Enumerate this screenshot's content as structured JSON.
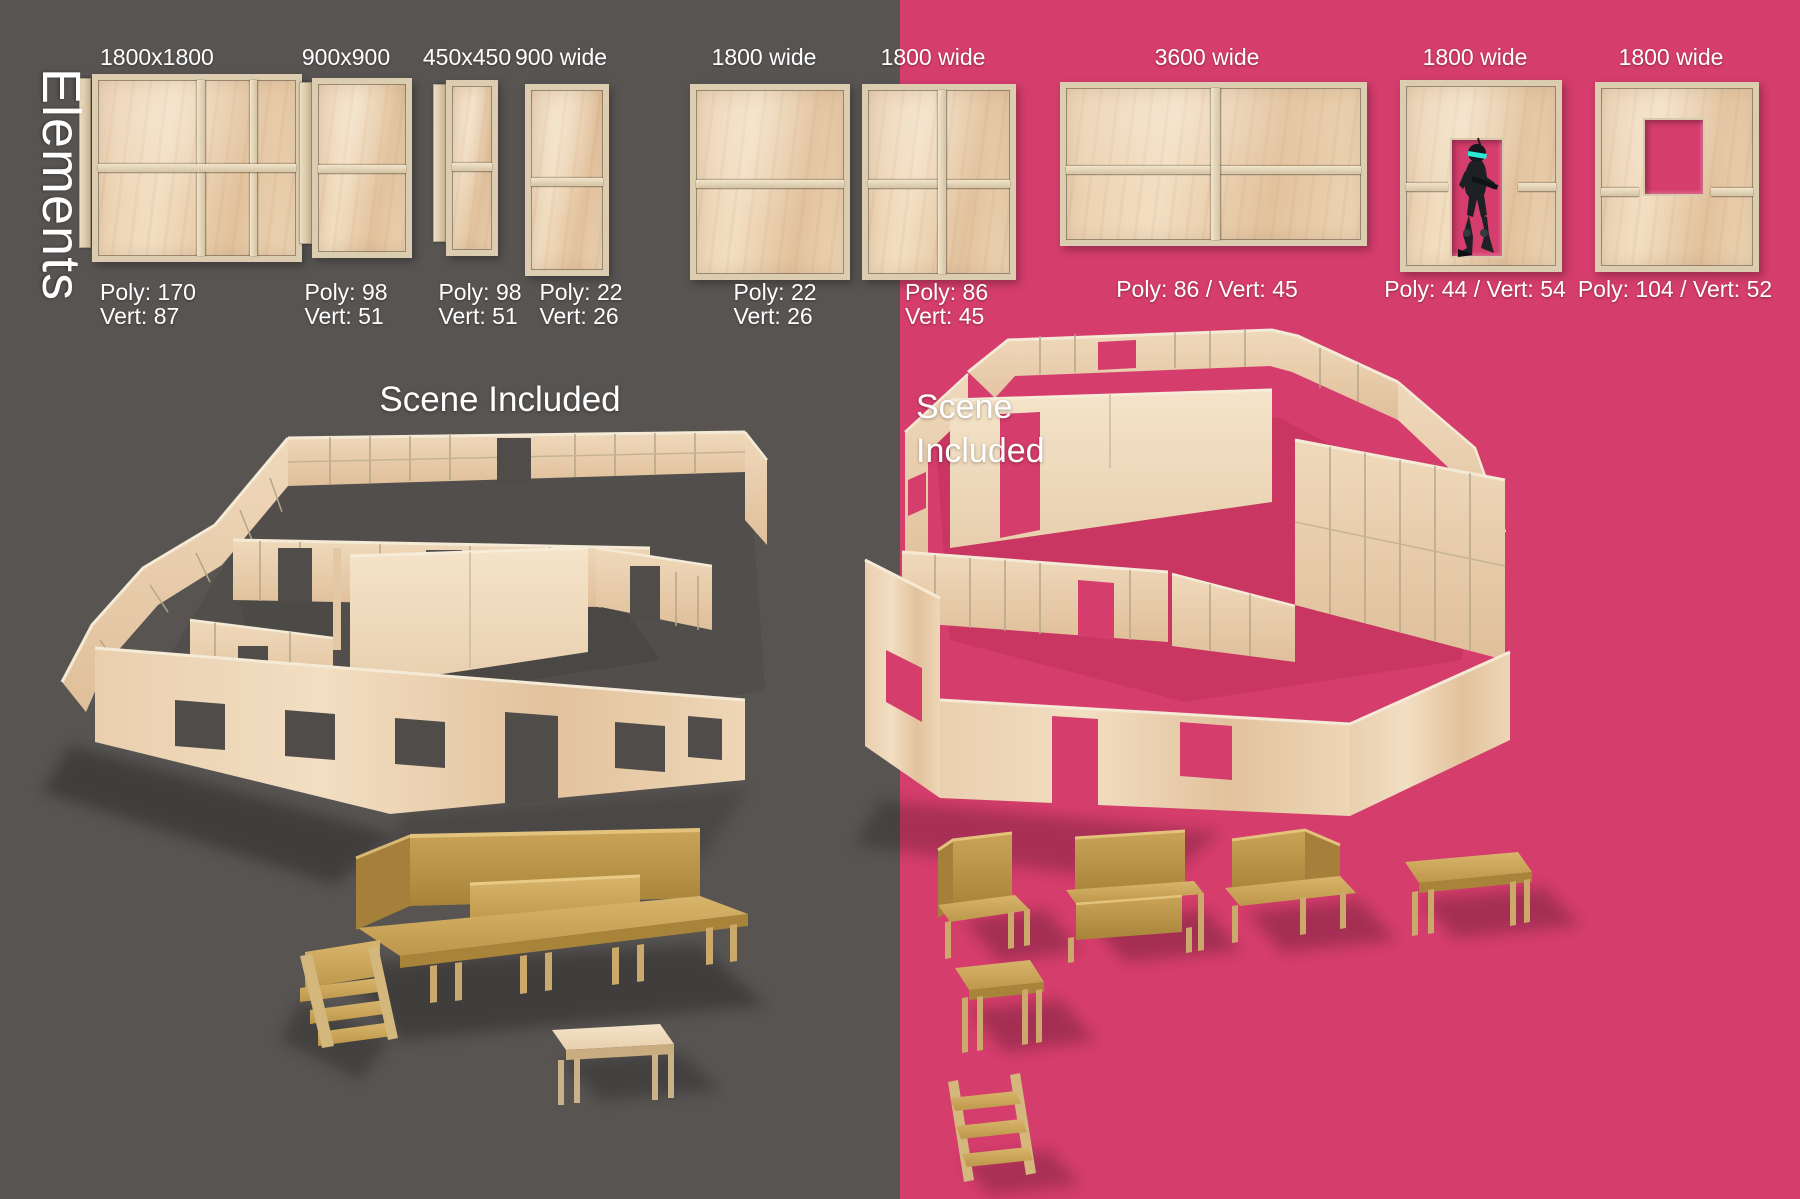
{
  "palette": {
    "bg_left": "#575452",
    "bg_right": "#d43d6c",
    "plywood": "#e8cfae",
    "osb": "#c29c52",
    "visor": "#2ee8d6",
    "text": "#ffffff"
  },
  "sidebar_title": "Elements",
  "elements": [
    {
      "id": "panel-1800x1800",
      "size_label": "1800x1800",
      "poly": "Poly: 170",
      "vert": "Vert: 87"
    },
    {
      "id": "panel-900x900",
      "size_label": "900x900",
      "poly": "Poly: 98",
      "vert": "Vert: 51"
    },
    {
      "id": "panel-450x450",
      "size_label": "450x450",
      "poly": "Poly: 98",
      "vert": "Vert: 51"
    },
    {
      "id": "panel-900-wide",
      "size_label": "900 wide",
      "poly": "Poly: 22",
      "vert": "Vert: 26"
    },
    {
      "id": "panel-1800-wide",
      "size_label": "1800 wide",
      "poly": "Poly: 22",
      "vert": "Vert: 26"
    },
    {
      "id": "panel-1800-wide-grid",
      "size_label": "1800 wide",
      "poly": "Poly: 86",
      "vert": "Vert: 45"
    },
    {
      "id": "panel-3600-wide",
      "size_label": "3600 wide",
      "stats": "Poly: 86 / Vert: 45"
    },
    {
      "id": "panel-1800-doorway",
      "size_label": "1800 wide",
      "stats": "Poly: 44 / Vert: 54"
    },
    {
      "id": "panel-1800-window",
      "size_label": "1800 wide",
      "stats": "Poly: 104 / Vert: 52"
    }
  ],
  "left_scene": {
    "caption": "Scene Included"
  },
  "right_scene": {
    "caption_line1": "Scene",
    "caption_line2": "Included"
  }
}
